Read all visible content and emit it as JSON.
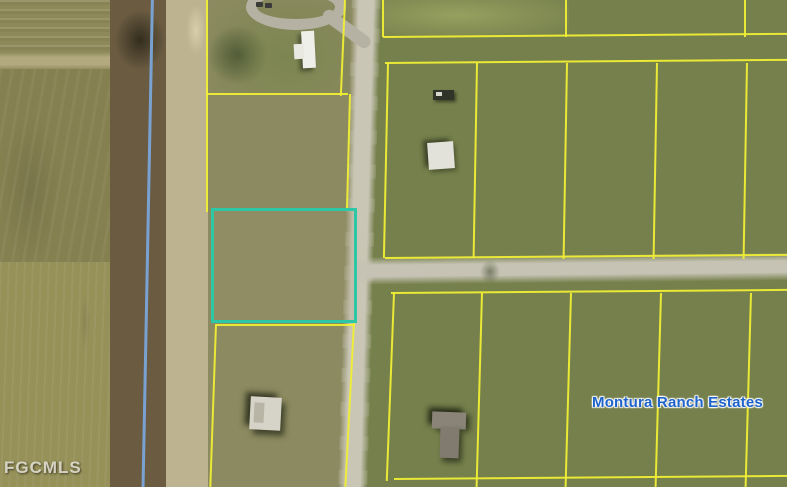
{
  "map": {
    "labels": {
      "area_name": "Montura Ranch Estates",
      "watermark": "FGCMLS"
    },
    "colors": {
      "parcel_boundary_line": "#f0ee35",
      "highlighted_parcel_outline": "#2cc7a4",
      "boundary_blue_line": "#7ba6d9",
      "area_label_text": "#1d63cb",
      "watermark_text": "#eeebe2",
      "road_surface": "#c9c6b6"
    }
  }
}
